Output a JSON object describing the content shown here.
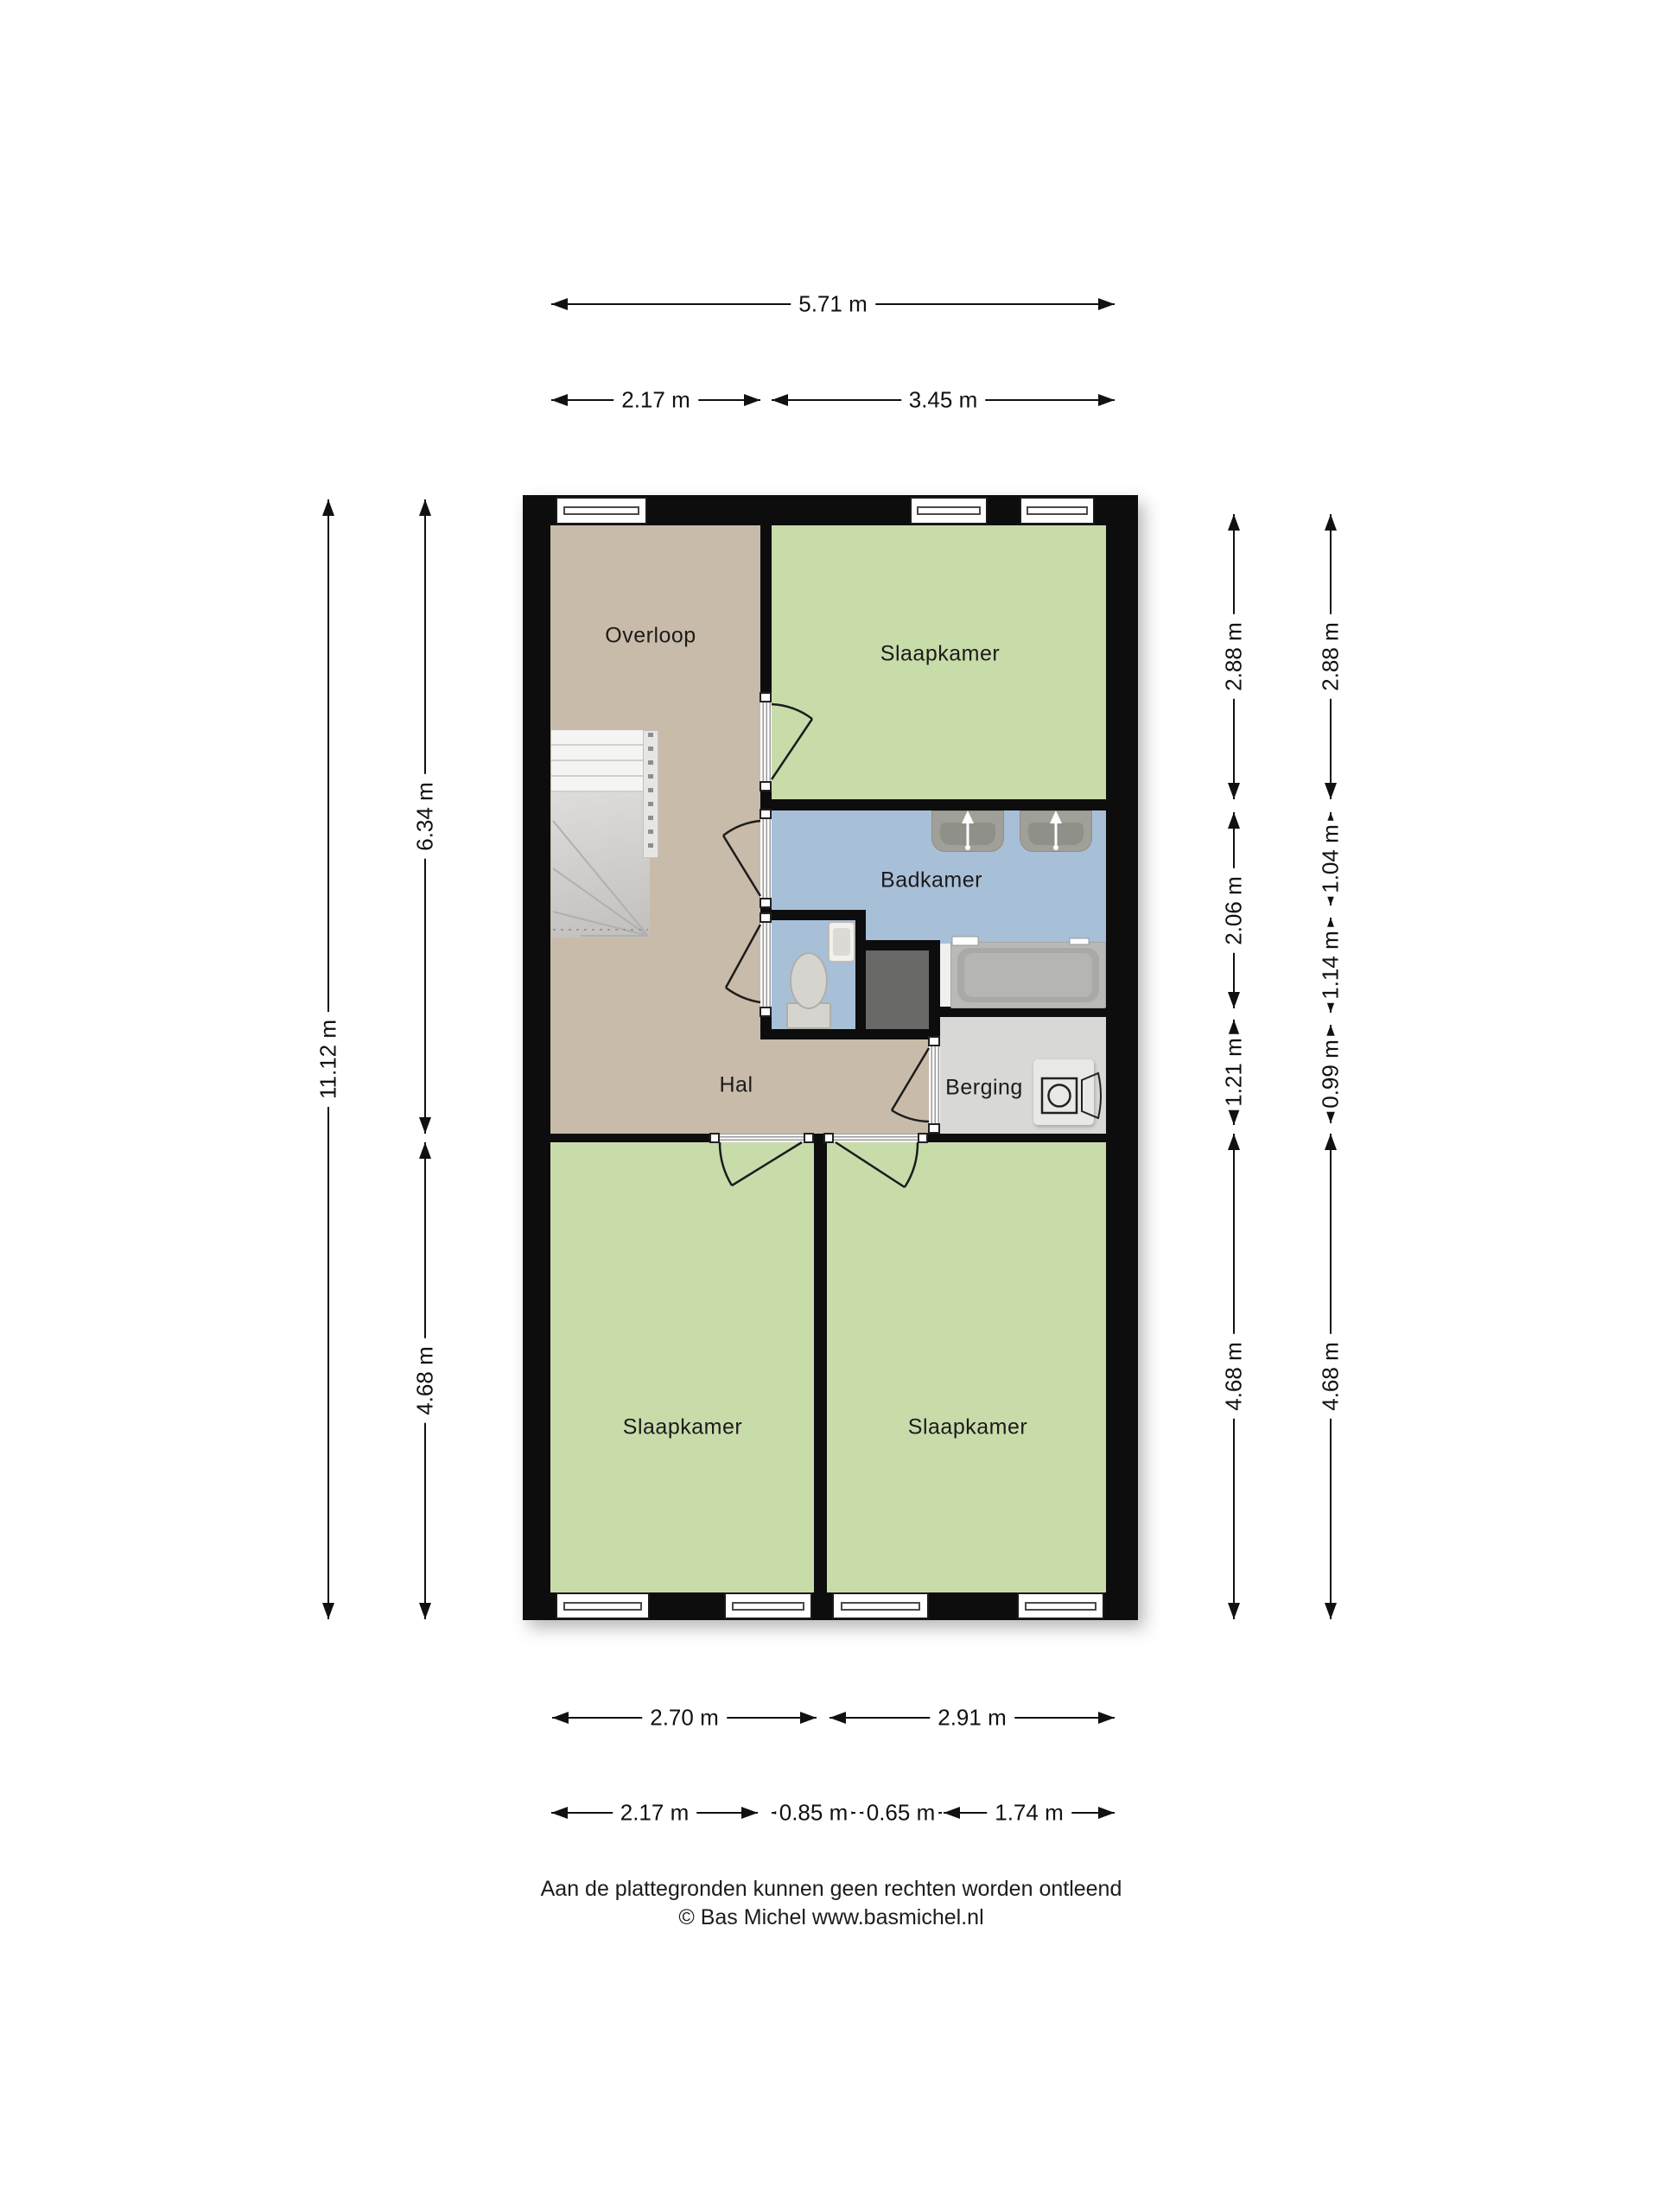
{
  "rooms": {
    "overloop": "Overloop",
    "slaapkamer_top": "Slaapkamer",
    "badkamer": "Badkamer",
    "hal": "Hal",
    "berging": "Berging",
    "slaapkamer_left": "Slaapkamer",
    "slaapkamer_right": "Slaapkamer"
  },
  "dimensions": {
    "top_total": "5.71 m",
    "top_left": "2.17 m",
    "top_right": "3.45 m",
    "left_total": "11.12 m",
    "left_upper": "6.34 m",
    "left_lower": "4.68 m",
    "right_inner": [
      "2.88 m",
      "2.06 m",
      "1.21 m",
      "4.68 m"
    ],
    "right_outer": [
      "2.88 m",
      "1.04 m",
      "1.14 m",
      "0.99 m",
      "4.68 m"
    ],
    "bottom_rooms_left": "2.70 m",
    "bottom_rooms_right": "2.91 m",
    "bottom_detail": [
      "2.17 m",
      "0.85 m",
      "0.65 m",
      "1.74 m"
    ]
  },
  "footer": {
    "disclaimer": "Aan de plattegronden kunnen geen rechten worden ontleend",
    "credit": "© Bas Michel www.basmichel.nl"
  },
  "colors": {
    "wall": "#0d0d0d",
    "floor_hall": "#c9bba9",
    "floor_bedroom": "#c8dcaa",
    "floor_bathroom": "#a8bfd8",
    "floor_storage": "#d8d8d6",
    "shaft": "#696967"
  }
}
